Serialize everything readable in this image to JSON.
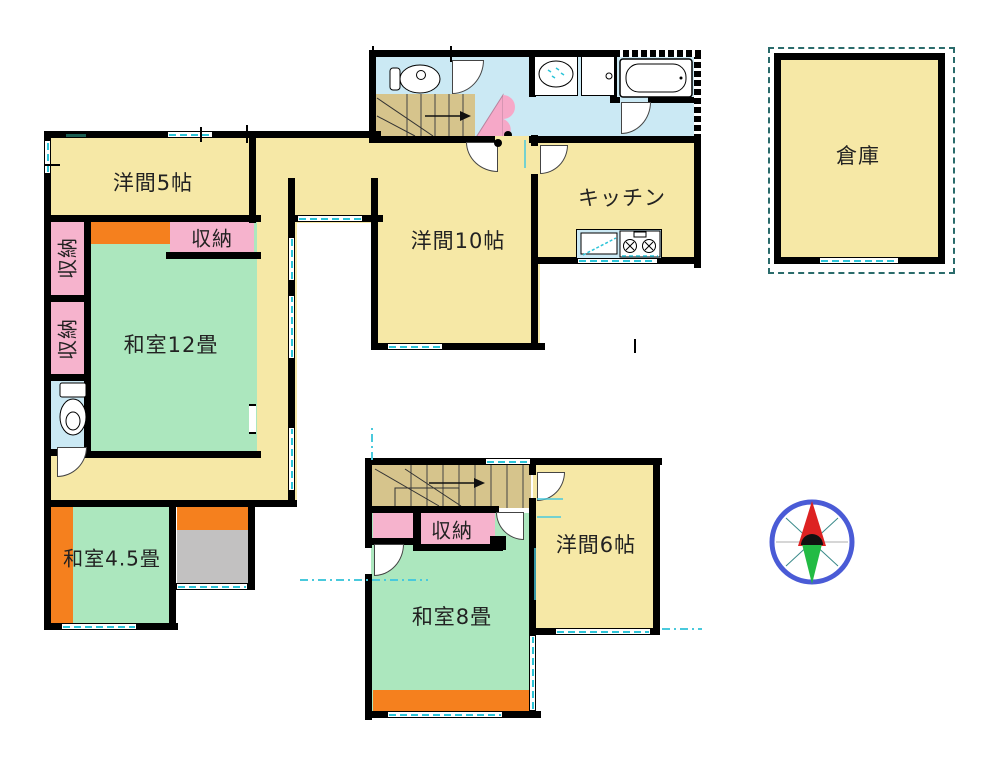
{
  "document": {
    "type": "japanese-floor-plan"
  },
  "rooms": {
    "yoma5": {
      "label": "洋間5帖"
    },
    "washitsu12": {
      "label": "和室12畳"
    },
    "yoma10": {
      "label": "洋間10帖"
    },
    "kitchen": {
      "label": "キッチン"
    },
    "souko": {
      "label": "倉庫"
    },
    "washitsu45": {
      "label": "和室4.5畳"
    },
    "washitsu8": {
      "label": "和室8畳"
    },
    "yoma6": {
      "label": "洋間6帖"
    },
    "closet": {
      "label": "収納"
    }
  },
  "colors": {
    "yellow": "#F6E8A6",
    "green": "#ACE7BE",
    "pink": "#F6B3CD",
    "orange": "#F5801E",
    "blue": "#CBE9F4",
    "tan": "#D6C48C",
    "gray": "#C2C1C1",
    "wall": "#000000",
    "window_teal": "#2CC4D8",
    "guide_teal": "#49C9DC",
    "outline_teal": "#2A6B6B",
    "compass_blue": "#4A5BD6",
    "compass_red": "#DD2222",
    "compass_green": "#22BB44",
    "door_pink": "#F6A8C8"
  }
}
